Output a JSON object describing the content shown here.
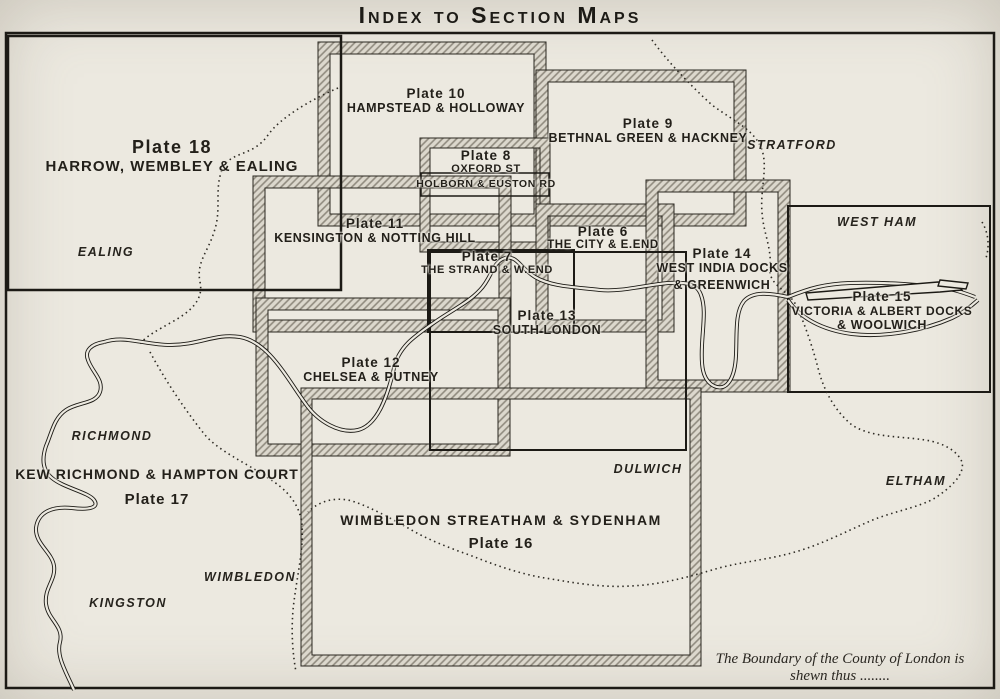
{
  "title": "Index to Section Maps",
  "plates": {
    "p18": {
      "number": "Plate 18",
      "name": "HARROW, WEMBLEY & EALING"
    },
    "p10": {
      "number": "Plate 10",
      "name": "HAMPSTEAD & HOLLOWAY"
    },
    "p9": {
      "number": "Plate 9",
      "name": "BETHNAL GREEN & HACKNEY"
    },
    "p8": {
      "number": "Plate 8",
      "name": "OXFORD ST",
      "name2": "HOLBORN & EUSTON RD"
    },
    "p11": {
      "number": "Plate 11",
      "name": "KENSINGTON & NOTTING HILL"
    },
    "p6": {
      "number": "Plate 6",
      "name": "THE CITY & E.END"
    },
    "p7": {
      "number": "Plate 7",
      "name": "THE STRAND & W.END"
    },
    "p14": {
      "number": "Plate 14",
      "name": "WEST INDIA DOCKS",
      "name2": "& GREENWICH"
    },
    "p15": {
      "number": "Plate 15",
      "name": "VICTORIA & ALBERT DOCKS",
      "name2": "& WOOLWICH"
    },
    "p13": {
      "number": "Plate 13",
      "name": "SOUTH LONDON"
    },
    "p12": {
      "number": "Plate 12",
      "name": "CHELSEA & PUTNEY"
    },
    "p17": {
      "number": "Plate 17",
      "name": "KEW RICHMOND & HAMPTON COURT"
    },
    "p16": {
      "number": "Plate 16",
      "name": "WIMBLEDON STREATHAM & SYDENHAM"
    }
  },
  "places": {
    "ealing": "EALING",
    "stratford": "STRATFORD",
    "west_ham": "WEST HAM",
    "richmond": "RICHMOND",
    "dulwich": "DULWICH",
    "eltham": "ELTHAM",
    "wimbledon": "WIMBLEDON",
    "kingston": "KINGSTON"
  },
  "note": {
    "line1": "The Boundary of the County of London is",
    "line2": "shewn thus ........"
  },
  "colors": {
    "ink": "#211f1a",
    "paper": "#ece9e0",
    "hatch_dark": "#8f8a7e",
    "hatch_light": "#dcd8cd"
  }
}
